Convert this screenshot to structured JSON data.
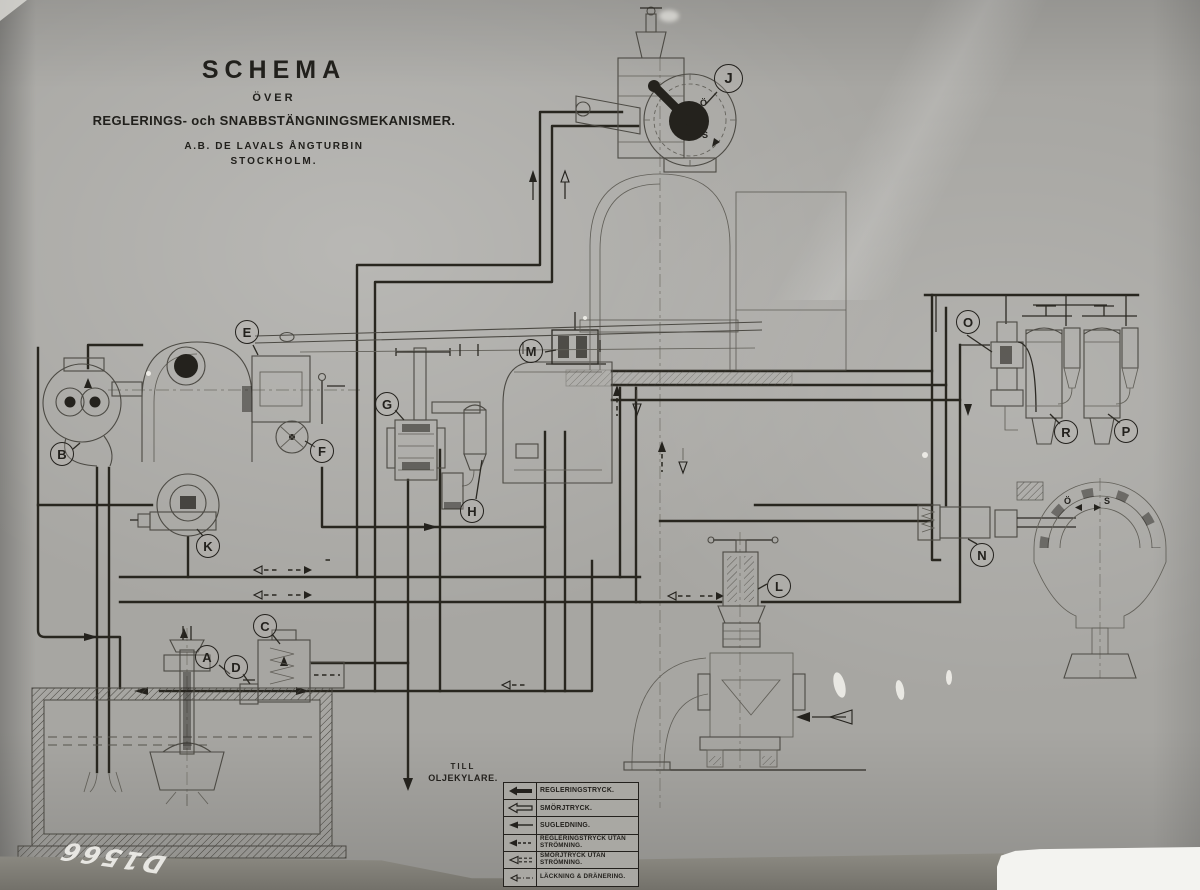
{
  "title_block": {
    "title": "SCHEMA",
    "over": "ÖVER",
    "mechanisms": "REGLERINGS- och SNABBSTÄNGNINGSMEKANISMER.",
    "company": "A.B. DE LAVALS ÅNGTURBIN",
    "city": "STOCKHOLM."
  },
  "drain_note": {
    "line1": "TILL",
    "line2": "OLJEKYLARE."
  },
  "legend": {
    "rows": [
      {
        "symbol": "solid-arrow",
        "label": "REGLERINGSTRYCK."
      },
      {
        "symbol": "outline-arrow",
        "label": "SMÖRJTRYCK."
      },
      {
        "symbol": "thin-solid-arrow",
        "label": "SUGLEDNING."
      },
      {
        "symbol": "solid-arrow-dashed-tail",
        "label": "REGLERINGSTRYCK UTAN STRÖMNING."
      },
      {
        "symbol": "outline-arrow-dashed-tail",
        "label": "SMÖRJTRYCK UTAN STRÖMNING."
      },
      {
        "symbol": "small-arrow-dashdot-tail",
        "label": "LÄCKNING & DRÄNERING."
      }
    ]
  },
  "components": [
    {
      "letter": "A"
    },
    {
      "letter": "B"
    },
    {
      "letter": "C"
    },
    {
      "letter": "D"
    },
    {
      "letter": "E"
    },
    {
      "letter": "F"
    },
    {
      "letter": "G"
    },
    {
      "letter": "H"
    },
    {
      "letter": "J"
    },
    {
      "letter": "K"
    },
    {
      "letter": "L"
    },
    {
      "letter": "M"
    },
    {
      "letter": "N"
    },
    {
      "letter": "O"
    },
    {
      "letter": "P"
    },
    {
      "letter": "R"
    }
  ],
  "marks": {
    "governor_open": "Ö",
    "governor_shut": "S",
    "servo_open": "Ö",
    "servo_shut": "S"
  },
  "photo_label": {
    "handwritten_number": "D1566"
  },
  "colors": {
    "paper": "#a7a6a2",
    "ink": "#23211d",
    "strip": "#7c7a72",
    "tear_white": "#f3f3f0"
  }
}
